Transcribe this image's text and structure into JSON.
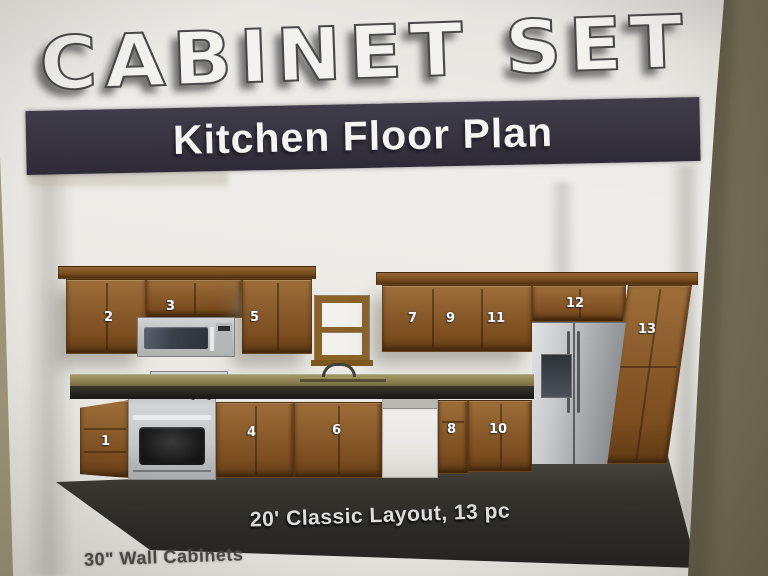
{
  "poster": {
    "title": "CABINET SET",
    "banner": "Kitchen Floor Plan",
    "caption": "20' Classic Layout, 13 pc",
    "footnote": "30\" Wall Cabinets",
    "labels": [
      "1",
      "2",
      "3",
      "4",
      "5",
      "6",
      "7",
      "8",
      "9",
      "10",
      "11",
      "12",
      "13"
    ]
  },
  "colors": {
    "wall": "#827c68",
    "paper": "#e9e7e2",
    "banner_bg": "#36333f",
    "cabinet_wood": "#8b5c2c",
    "countertop": "#8b8050",
    "floor": "#2c2a26",
    "stainless": "#c3c5c6",
    "label_text": "#ffffff"
  }
}
